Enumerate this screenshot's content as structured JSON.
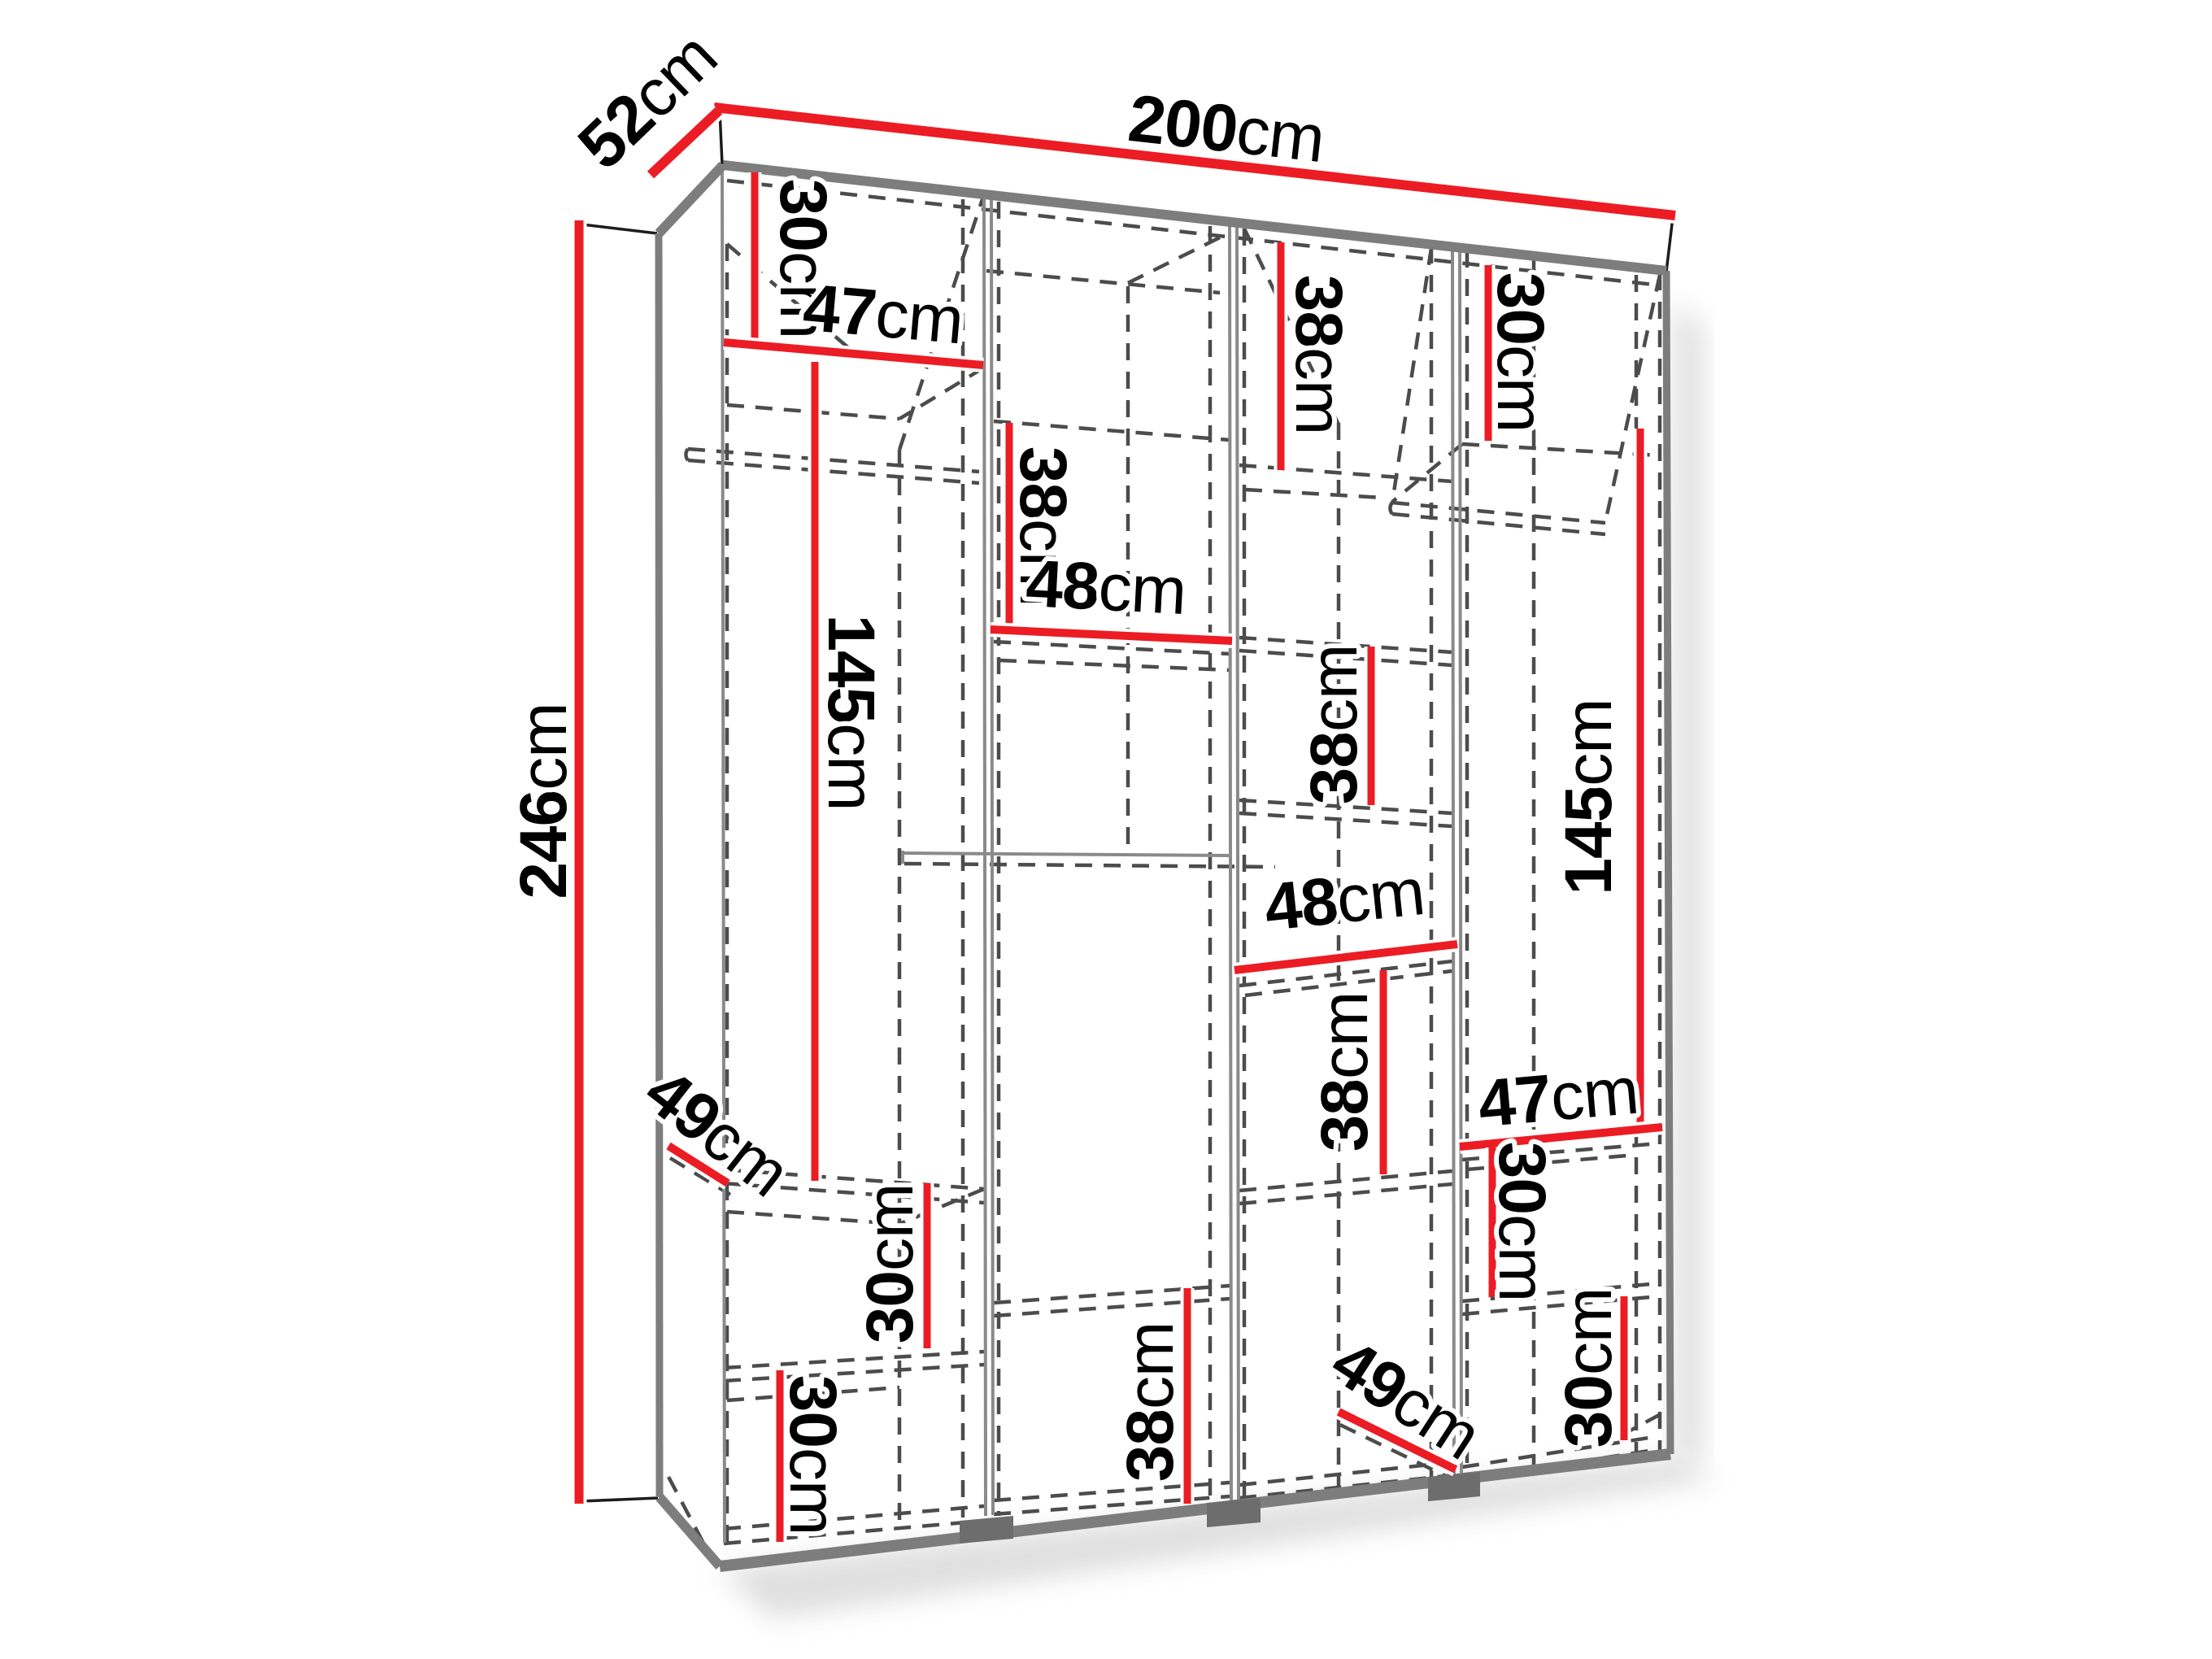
{
  "page": {
    "type": "furniture-dimension-diagram",
    "subject": "Four-section open wardrobe shown in perspective with internal shelves and hanging rails",
    "background": "#ffffff"
  },
  "colors": {
    "dimension_line": "#ec1c24",
    "label_text": "#000000",
    "outline_dark": "#1d1d1d",
    "frame_gray": "#7d7d7d",
    "hidden_edge": "#4c4c4c",
    "foot_gray": "#6d6d6d",
    "shadow": "#bfbfbf"
  },
  "unit": "cm",
  "overall_dimensions": {
    "width": "200",
    "depth": "52",
    "height": "246"
  },
  "dimension_labels": [
    {
      "id": "total_width",
      "value": "200",
      "unit": "cm"
    },
    {
      "id": "total_depth",
      "value": "52",
      "unit": "cm"
    },
    {
      "id": "total_height",
      "value": "246",
      "unit": "cm"
    },
    {
      "id": "col1_top_shelf_height",
      "value": "30",
      "unit": "cm"
    },
    {
      "id": "col1_width",
      "value": "47",
      "unit": "cm"
    },
    {
      "id": "col3_top_shelf_height",
      "value": "38",
      "unit": "cm"
    },
    {
      "id": "col4_top_shelf_height",
      "value": "30",
      "unit": "cm"
    },
    {
      "id": "col2_upper_shelf_height",
      "value": "38",
      "unit": "cm"
    },
    {
      "id": "col2_width",
      "value": "48",
      "unit": "cm"
    },
    {
      "id": "col1_hanging_height",
      "value": "145",
      "unit": "cm"
    },
    {
      "id": "col3_mid_shelf_height",
      "value": "38",
      "unit": "cm"
    },
    {
      "id": "col4_hanging_height",
      "value": "145",
      "unit": "cm"
    },
    {
      "id": "col3_width",
      "value": "48",
      "unit": "cm"
    },
    {
      "id": "col3_lower_shelf_height",
      "value": "38",
      "unit": "cm"
    },
    {
      "id": "col4_width",
      "value": "47",
      "unit": "cm"
    },
    {
      "id": "col4_shelf_height_upper",
      "value": "30",
      "unit": "cm"
    },
    {
      "id": "col4_shelf_height_lower",
      "value": "30",
      "unit": "cm"
    },
    {
      "id": "col1_shelf_depth",
      "value": "49",
      "unit": "cm"
    },
    {
      "id": "col1_shelf_height_mid",
      "value": "30",
      "unit": "cm"
    },
    {
      "id": "col1_shelf_height_bottom",
      "value": "30",
      "unit": "cm"
    },
    {
      "id": "col2_bottom_shelf_height",
      "value": "38",
      "unit": "cm"
    },
    {
      "id": "col3_bottom_depth",
      "value": "49",
      "unit": "cm"
    }
  ]
}
